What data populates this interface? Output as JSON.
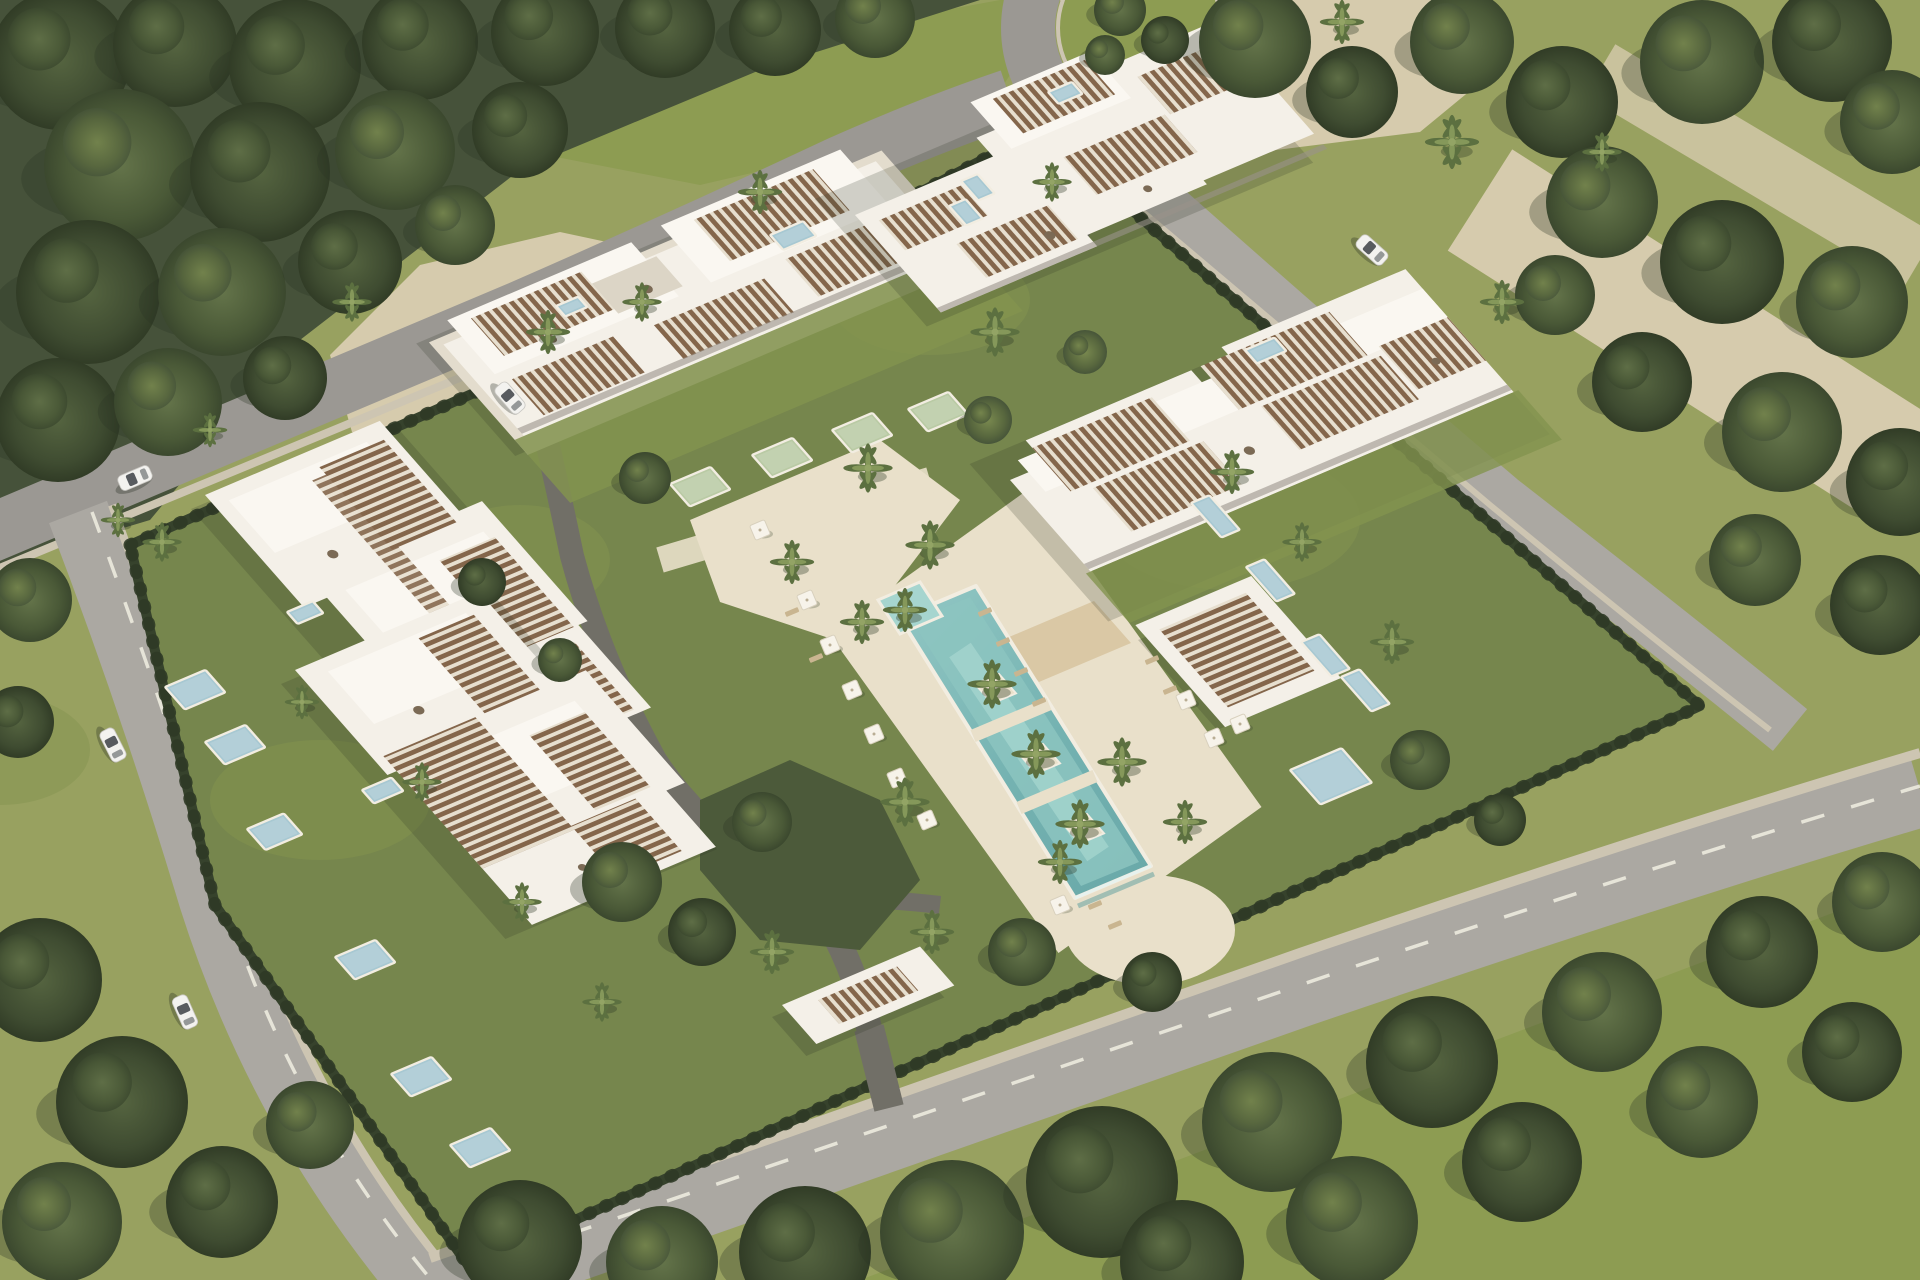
{
  "scene": {
    "kind": "aerial-architectural-render",
    "subject": "luxury residential resort complex with five white apartment buildings, central lagoon pool, private plunge pools, palm gardens, perimeter roads and surrounding woodland",
    "view": "oblique aerial",
    "buildings": [
      {
        "id": "west-residence"
      },
      {
        "id": "southwest-residence"
      },
      {
        "id": "north-residence"
      },
      {
        "id": "northeast-residence"
      },
      {
        "id": "east-residence"
      },
      {
        "id": "pool-pavilion"
      },
      {
        "id": "entrance-gate"
      }
    ]
  },
  "palette": {
    "asphalt": "#9b9893",
    "asphalt2": "#aba8a2",
    "walk": "#cdc5b2",
    "line": "#eceade",
    "sand": "#d6cbad",
    "lawn": "#98a160",
    "lawn2": "#8d9c52",
    "forest": "#46523a",
    "plot": "#76864d",
    "plot2": "#83934f",
    "hedge": "#36422c",
    "deck": "#e9e0ca",
    "drive": "#716f67",
    "bld": "#f4f0e8",
    "bld2": "#faf7f1",
    "bld3": "#e3dccd",
    "slat": "#84664b",
    "slatbg": "#e7dfcf",
    "pool": "#76b4b2",
    "pool2": "#a6d5cf",
    "plungeBlue": "#a7c8d2",
    "plungeGreen": "#b9caa4",
    "coping": "#f2ede1",
    "car": "#f3f2ef",
    "glass": "#3c4145",
    "wood": "#d9c6a2",
    "umb": "#f7f3ea"
  },
  "objects": {
    "plunge_pools": [
      {
        "x": 670,
        "y": 484,
        "w": 44,
        "h": 30,
        "c": "plungeGreen"
      },
      {
        "x": 752,
        "y": 455,
        "w": 44,
        "h": 30,
        "c": "plungeGreen"
      },
      {
        "x": 832,
        "y": 430,
        "w": 44,
        "h": 30,
        "c": "plungeGreen"
      },
      {
        "x": 908,
        "y": 409,
        "w": 44,
        "h": 30,
        "c": "plungeGreen"
      },
      {
        "x": 165,
        "y": 687,
        "w": 44,
        "h": 30,
        "c": "plungeBlue"
      },
      {
        "x": 205,
        "y": 742,
        "w": 44,
        "h": 30,
        "c": "plungeBlue"
      },
      {
        "x": 247,
        "y": 829,
        "w": 40,
        "h": 28,
        "c": "plungeBlue"
      },
      {
        "x": 335,
        "y": 957,
        "w": 44,
        "h": 30,
        "c": "plungeBlue"
      },
      {
        "x": 391,
        "y": 1074,
        "w": 44,
        "h": 30,
        "c": "plungeBlue"
      },
      {
        "x": 450,
        "y": 1145,
        "w": 44,
        "h": 30,
        "c": "plungeBlue"
      },
      {
        "x": 1191,
        "y": 503,
        "w": 20,
        "h": 46,
        "c": "plungeBlue"
      },
      {
        "x": 1246,
        "y": 567,
        "w": 20,
        "h": 46,
        "c": "plungeBlue"
      },
      {
        "x": 1301,
        "y": 642,
        "w": 20,
        "h": 46,
        "c": "plungeBlue"
      },
      {
        "x": 1341,
        "y": 677,
        "w": 20,
        "h": 46,
        "c": "plungeBlue"
      },
      {
        "x": 961,
        "y": 181,
        "w": 18,
        "h": 26,
        "c": "plungeBlue"
      },
      {
        "x": 949,
        "y": 206,
        "w": 18,
        "h": 26,
        "c": "plungeBlue"
      },
      {
        "x": 1290,
        "y": 770,
        "w": 56,
        "h": 46,
        "c": "plungeBlue"
      },
      {
        "x": 770,
        "y": 235,
        "w": 36,
        "h": 20,
        "c": "plungeBlue"
      },
      {
        "x": 1048,
        "y": 92,
        "w": 26,
        "h": 16,
        "c": "plungeBlue"
      },
      {
        "x": 287,
        "y": 612,
        "w": 28,
        "h": 16,
        "c": "plungeBlue"
      },
      {
        "x": 362,
        "y": 790,
        "w": 32,
        "h": 18,
        "c": "plungeBlue"
      },
      {
        "x": 1245,
        "y": 350,
        "w": 32,
        "h": 18,
        "c": "plungeBlue"
      },
      {
        "x": 556,
        "y": 306,
        "w": 24,
        "h": 14,
        "c": "plungeBlue"
      }
    ],
    "cars": [
      {
        "x": 135,
        "y": 478,
        "a": -23
      },
      {
        "x": 113,
        "y": 745,
        "a": 63
      },
      {
        "x": 185,
        "y": 1012,
        "a": 66
      },
      {
        "x": 1372,
        "y": 250,
        "a": 42
      },
      {
        "x": 510,
        "y": 398,
        "a": 49
      }
    ],
    "umbrellas": [
      {
        "x": 807,
        "y": 600
      },
      {
        "x": 830,
        "y": 645
      },
      {
        "x": 852,
        "y": 690
      },
      {
        "x": 874,
        "y": 734
      },
      {
        "x": 897,
        "y": 778
      },
      {
        "x": 927,
        "y": 820
      },
      {
        "x": 1186,
        "y": 700
      },
      {
        "x": 1214,
        "y": 738
      },
      {
        "x": 1240,
        "y": 724
      },
      {
        "x": 1060,
        "y": 905
      },
      {
        "x": 760,
        "y": 530
      }
    ],
    "loungers": [
      {
        "x": 985,
        "y": 612
      },
      {
        "x": 1003,
        "y": 642
      },
      {
        "x": 1021,
        "y": 672
      },
      {
        "x": 1039,
        "y": 702
      },
      {
        "x": 1152,
        "y": 660
      },
      {
        "x": 1170,
        "y": 690
      },
      {
        "x": 1095,
        "y": 905
      },
      {
        "x": 1115,
        "y": 925
      },
      {
        "x": 792,
        "y": 612
      },
      {
        "x": 816,
        "y": 658
      }
    ],
    "palms": [
      {
        "x": 995,
        "y": 332,
        "s": 1
      },
      {
        "x": 760,
        "y": 192,
        "s": 0.9
      },
      {
        "x": 548,
        "y": 332,
        "s": 0.9
      },
      {
        "x": 352,
        "y": 302,
        "s": 0.8
      },
      {
        "x": 642,
        "y": 302,
        "s": 0.8
      },
      {
        "x": 162,
        "y": 542,
        "s": 0.8
      },
      {
        "x": 868,
        "y": 468,
        "s": 1
      },
      {
        "x": 930,
        "y": 545,
        "s": 1
      },
      {
        "x": 992,
        "y": 684,
        "s": 1
      },
      {
        "x": 1036,
        "y": 754,
        "s": 1
      },
      {
        "x": 1080,
        "y": 824,
        "s": 1
      },
      {
        "x": 905,
        "y": 610,
        "s": 0.9
      },
      {
        "x": 862,
        "y": 622,
        "s": 0.9
      },
      {
        "x": 792,
        "y": 562,
        "s": 0.9
      },
      {
        "x": 905,
        "y": 802,
        "s": 1
      },
      {
        "x": 1122,
        "y": 762,
        "s": 1
      },
      {
        "x": 1185,
        "y": 822,
        "s": 0.9
      },
      {
        "x": 772,
        "y": 952,
        "s": 0.9
      },
      {
        "x": 932,
        "y": 932,
        "s": 0.9
      },
      {
        "x": 1060,
        "y": 862,
        "s": 0.9
      },
      {
        "x": 1232,
        "y": 472,
        "s": 0.9
      },
      {
        "x": 1302,
        "y": 542,
        "s": 0.8
      },
      {
        "x": 1392,
        "y": 642,
        "s": 0.9
      },
      {
        "x": 1452,
        "y": 142,
        "s": 1.1
      },
      {
        "x": 1342,
        "y": 22,
        "s": 0.9
      },
      {
        "x": 1052,
        "y": 182,
        "s": 0.8
      },
      {
        "x": 422,
        "y": 782,
        "s": 0.8
      },
      {
        "x": 522,
        "y": 902,
        "s": 0.8
      },
      {
        "x": 602,
        "y": 1002,
        "s": 0.8
      },
      {
        "x": 302,
        "y": 702,
        "s": 0.7
      },
      {
        "x": 1502,
        "y": 302,
        "s": 0.9
      },
      {
        "x": 1602,
        "y": 152,
        "s": 0.8
      },
      {
        "x": 210,
        "y": 430,
        "s": 0.7
      },
      {
        "x": 118,
        "y": 520,
        "s": 0.7
      }
    ],
    "trees": [
      {
        "x": 60,
        "y": 60,
        "r": 70,
        "t": 0
      },
      {
        "x": 175,
        "y": 45,
        "r": 62,
        "t": 0
      },
      {
        "x": 295,
        "y": 65,
        "r": 66,
        "t": 0
      },
      {
        "x": 420,
        "y": 42,
        "r": 58,
        "t": 0
      },
      {
        "x": 545,
        "y": 32,
        "r": 54,
        "t": 0
      },
      {
        "x": 665,
        "y": 28,
        "r": 50,
        "t": 0
      },
      {
        "x": 775,
        "y": 30,
        "r": 46,
        "t": 0
      },
      {
        "x": 875,
        "y": 18,
        "r": 40,
        "t": 1
      },
      {
        "x": 120,
        "y": 165,
        "r": 76,
        "t": 1
      },
      {
        "x": 260,
        "y": 172,
        "r": 70,
        "t": 0
      },
      {
        "x": 395,
        "y": 150,
        "r": 60,
        "t": 1
      },
      {
        "x": 520,
        "y": 130,
        "r": 48,
        "t": 0
      },
      {
        "x": 88,
        "y": 292,
        "r": 72,
        "t": 0
      },
      {
        "x": 222,
        "y": 292,
        "r": 64,
        "t": 1
      },
      {
        "x": 350,
        "y": 262,
        "r": 52,
        "t": 0
      },
      {
        "x": 455,
        "y": 225,
        "r": 40,
        "t": 1
      },
      {
        "x": 58,
        "y": 420,
        "r": 62,
        "t": 0
      },
      {
        "x": 168,
        "y": 402,
        "r": 54,
        "t": 1
      },
      {
        "x": 285,
        "y": 378,
        "r": 42,
        "t": 0
      },
      {
        "x": 30,
        "y": 600,
        "r": 42,
        "t": 1
      },
      {
        "x": 18,
        "y": 722,
        "r": 36,
        "t": 0
      },
      {
        "x": 1255,
        "y": 42,
        "r": 56,
        "t": 1
      },
      {
        "x": 1352,
        "y": 92,
        "r": 46,
        "t": 0
      },
      {
        "x": 1462,
        "y": 42,
        "r": 52,
        "t": 1
      },
      {
        "x": 1562,
        "y": 102,
        "r": 56,
        "t": 0
      },
      {
        "x": 1702,
        "y": 62,
        "r": 62,
        "t": 1
      },
      {
        "x": 1832,
        "y": 42,
        "r": 60,
        "t": 0
      },
      {
        "x": 1892,
        "y": 122,
        "r": 52,
        "t": 1
      },
      {
        "x": 1602,
        "y": 202,
        "r": 56,
        "t": 1
      },
      {
        "x": 1722,
        "y": 262,
        "r": 62,
        "t": 0
      },
      {
        "x": 1852,
        "y": 302,
        "r": 56,
        "t": 1
      },
      {
        "x": 1642,
        "y": 382,
        "r": 50,
        "t": 0
      },
      {
        "x": 1782,
        "y": 432,
        "r": 60,
        "t": 1
      },
      {
        "x": 1900,
        "y": 482,
        "r": 54,
        "t": 0
      },
      {
        "x": 1555,
        "y": 295,
        "r": 40,
        "t": 1
      },
      {
        "x": 1755,
        "y": 560,
        "r": 46,
        "t": 1
      },
      {
        "x": 1880,
        "y": 605,
        "r": 50,
        "t": 0
      },
      {
        "x": 40,
        "y": 980,
        "r": 62,
        "t": 0
      },
      {
        "x": 122,
        "y": 1102,
        "r": 66,
        "t": 0
      },
      {
        "x": 62,
        "y": 1222,
        "r": 60,
        "t": 1
      },
      {
        "x": 222,
        "y": 1202,
        "r": 56,
        "t": 0
      },
      {
        "x": 310,
        "y": 1125,
        "r": 44,
        "t": 1
      },
      {
        "x": 520,
        "y": 1242,
        "r": 62,
        "t": 0
      },
      {
        "x": 662,
        "y": 1262,
        "r": 56,
        "t": 1
      },
      {
        "x": 805,
        "y": 1252,
        "r": 66,
        "t": 0
      },
      {
        "x": 952,
        "y": 1232,
        "r": 72,
        "t": 1
      },
      {
        "x": 1102,
        "y": 1182,
        "r": 76,
        "t": 0
      },
      {
        "x": 1272,
        "y": 1122,
        "r": 70,
        "t": 1
      },
      {
        "x": 1432,
        "y": 1062,
        "r": 66,
        "t": 0
      },
      {
        "x": 1602,
        "y": 1012,
        "r": 60,
        "t": 1
      },
      {
        "x": 1762,
        "y": 952,
        "r": 56,
        "t": 0
      },
      {
        "x": 1882,
        "y": 902,
        "r": 50,
        "t": 1
      },
      {
        "x": 1182,
        "y": 1262,
        "r": 62,
        "t": 0
      },
      {
        "x": 1352,
        "y": 1222,
        "r": 66,
        "t": 1
      },
      {
        "x": 1522,
        "y": 1162,
        "r": 60,
        "t": 0
      },
      {
        "x": 1702,
        "y": 1102,
        "r": 56,
        "t": 1
      },
      {
        "x": 1852,
        "y": 1052,
        "r": 50,
        "t": 0
      },
      {
        "x": 622,
        "y": 882,
        "r": 40,
        "t": 1
      },
      {
        "x": 702,
        "y": 932,
        "r": 34,
        "t": 0
      },
      {
        "x": 762,
        "y": 822,
        "r": 30,
        "t": 1
      },
      {
        "x": 1022,
        "y": 952,
        "r": 34,
        "t": 1
      },
      {
        "x": 1152,
        "y": 982,
        "r": 30,
        "t": 0
      },
      {
        "x": 645,
        "y": 478,
        "r": 26,
        "t": 1
      },
      {
        "x": 988,
        "y": 420,
        "r": 24,
        "t": 2
      },
      {
        "x": 1085,
        "y": 352,
        "r": 22,
        "t": 2
      },
      {
        "x": 482,
        "y": 582,
        "r": 24,
        "t": 0
      },
      {
        "x": 560,
        "y": 660,
        "r": 22,
        "t": 1
      },
      {
        "x": 1420,
        "y": 760,
        "r": 30,
        "t": 1
      },
      {
        "x": 1500,
        "y": 820,
        "r": 26,
        "t": 0
      },
      {
        "x": 1120,
        "y": 10,
        "r": 26,
        "t": 1
      },
      {
        "x": 1165,
        "y": 40,
        "r": 24,
        "t": 0
      },
      {
        "x": 1105,
        "y": 55,
        "r": 20,
        "t": 1
      }
    ]
  }
}
